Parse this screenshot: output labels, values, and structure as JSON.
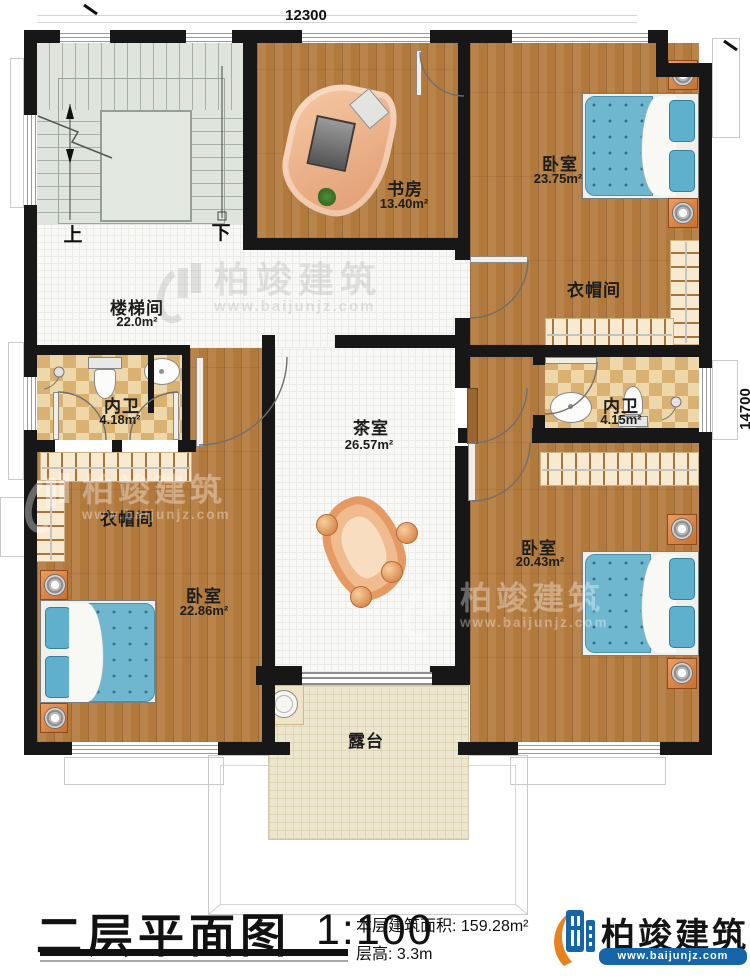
{
  "plan": {
    "dimensions": {
      "width_top": "12300",
      "height_right": "14700"
    },
    "stairs": {
      "up_label": "上",
      "down_label": "下"
    },
    "rooms": [
      {
        "id": "study",
        "name": "书房",
        "area": "13.40m²"
      },
      {
        "id": "bedroom-ne",
        "name": "卧室",
        "area": "23.75m²"
      },
      {
        "id": "cloakroom-e",
        "name": "衣帽间",
        "area": ""
      },
      {
        "id": "stairwell",
        "name": "楼梯间",
        "area": "22.0m²"
      },
      {
        "id": "bath-w",
        "name": "内卫",
        "area": "4.18m²"
      },
      {
        "id": "bath-e",
        "name": "内卫",
        "area": "4.15m²"
      },
      {
        "id": "tea-room",
        "name": "茶室",
        "area": "26.57m²"
      },
      {
        "id": "cloakroom-w",
        "name": "衣帽间",
        "area": ""
      },
      {
        "id": "bedroom-sw",
        "name": "卧室",
        "area": "22.86m²"
      },
      {
        "id": "bedroom-se",
        "name": "卧室",
        "area": "20.43m²"
      },
      {
        "id": "terrace",
        "name": "露台",
        "area": ""
      }
    ],
    "watermark": {
      "name": "柏竣建筑",
      "url": "www.baijunjz.com"
    }
  },
  "title_block": {
    "plan_title": "二层平面图",
    "scale": "1:100",
    "area_label": "本层建筑面积:",
    "area_value": "159.28m²",
    "height_label": "层高:",
    "height_value": "3.3m"
  },
  "branding": {
    "company": "柏竣建筑",
    "website": "www.baijunjz.com"
  },
  "colors": {
    "brand_blue": "#1565a8",
    "brand_orange": "#e8821e",
    "wall": "#171717",
    "wood": "#b2793c",
    "bed_blue": "#6fb7cf"
  }
}
